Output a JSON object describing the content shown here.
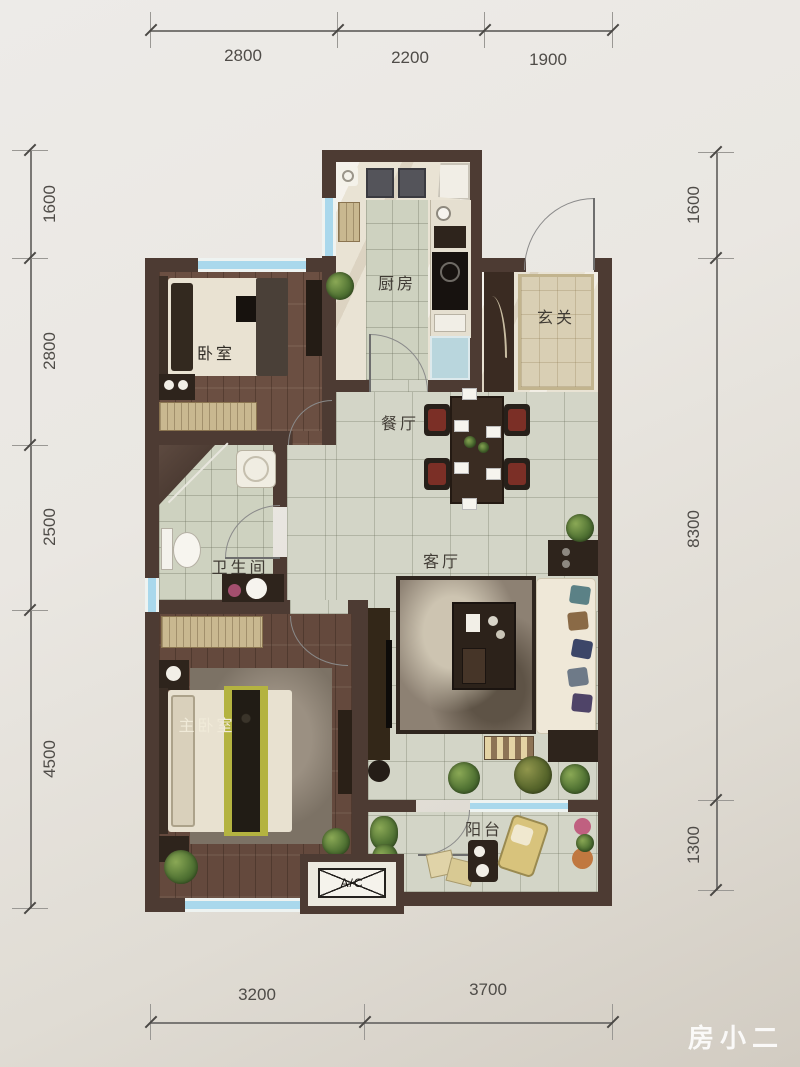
{
  "watermark": "房小二",
  "dimensions": {
    "top": [
      "2800",
      "2200",
      "1900"
    ],
    "left": [
      "1600",
      "2800",
      "2500",
      "4500"
    ],
    "right": [
      "1600",
      "8300",
      "1300"
    ],
    "bottom": [
      "3200",
      "3700"
    ]
  },
  "rooms": {
    "kitchen": "厨房",
    "entry": "玄关",
    "bedroom": "卧室",
    "dining": "餐厅",
    "bathroom": "卫生间",
    "living": "客厅",
    "master_bedroom": "主卧室",
    "balcony": "阳台"
  },
  "labels": {
    "ac_unit": "A/C"
  },
  "colors": {
    "wall": "#4d3b33",
    "wood_floor": "#6b4f42",
    "tile_floor": "#d3d5c7",
    "window_glass": "#a9d8ec",
    "paper": "#e9e6e1",
    "dimension_text": "#4f4c48"
  }
}
